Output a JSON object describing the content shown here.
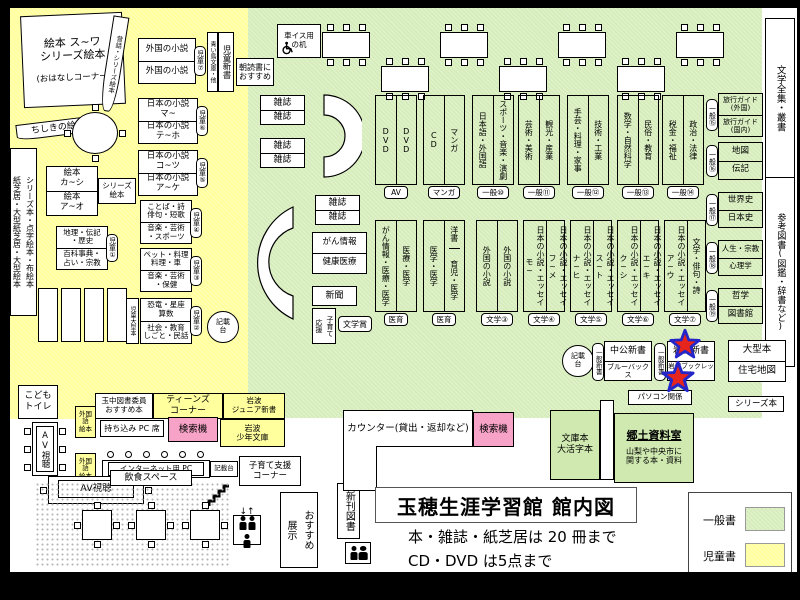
{
  "title": {
    "heading": "玉穂生涯学習館 館内図",
    "rule1": "本・雑誌・紙芝居は 20 冊まで",
    "rule2": "CD・DVD は5点まで"
  },
  "legend": {
    "general": "一般書",
    "children": "児童書"
  },
  "colors": {
    "children_area": "#ffff9e",
    "general_area": "#d6edbb",
    "search_machine": "#f7a3c8",
    "star_fill": "#e8251d",
    "star_outline": "#2426c8"
  },
  "children_area": {
    "ohanashi_line1": "絵本 ス~ワ",
    "ohanashi_line2": "シリーズ絵本",
    "ohanashi_line3": "(おはなしコーナー)",
    "mukashibanashi_strip": "昔話・シリーズ絵本",
    "chishiki_strip": "ちしきの絵本",
    "left_wall_strip": "シリーズ本・点字絵本・布絵本\n紙芝居・大型紙芝居・大型絵本",
    "ehon_top": "絵本\nカ~シ",
    "ehon_bottom": "絵本\nア~オ",
    "ehon_side": "シリーズ\n絵本",
    "ref_top": "地理・伝記\n・歴史",
    "ref_bottom": "百科事典・\n占い・宗教",
    "ref_badge": "児童①",
    "foreign_top": "外国の小説",
    "foreign_bottom": "外国の小説",
    "foreign_badge": "児童⑦",
    "aoitori_strip": "青い鳥文庫・他",
    "jido_shinsho_strip": "児童新書",
    "asadoku": "朝読書に\nおすすめ",
    "jnovel1_top": "日本の小説\nマ~",
    "jnovel1_bottom": "日本の小説\nテ~ホ",
    "jnovel1_badge": "児童⑥",
    "jnovel2_top": "日本の小説\nコ~ツ",
    "jnovel2_bottom": "日本の小説\nア~ケ",
    "jnovel2_badge": "児童⑤",
    "kotoba_top": "ことば・詩\n俳句・短歌",
    "kotoba_bottom": "音楽・芸術\n・スポーツ",
    "kotoba_badge": "児童④",
    "pet_top": "ペット・料理\n料理・車",
    "pet_bottom": "音楽・芸術\n・保健",
    "pet_badge": "児童③",
    "kyoryu_top": "恐竜・星座\n算数",
    "kyoryu_bottom": "社会・教育\nしごと・民話",
    "kyoryu_badge": "児童②",
    "kyoryu_side": "児童大型本",
    "kisaidai_circle": "記載\n台",
    "kids_toilet": "こども\nトイレ"
  },
  "teens_area": {
    "recommend": "玉中図書委員\nおすすめ本",
    "teens_corner": "ティーンズ\nコーナー",
    "iwanami_junior": "岩波\nジュニア新書",
    "foreign_picture1": "外国語\n絵本",
    "foreign_picture2": "外国語\n絵本",
    "byo_pc": "持ち込み PC 席",
    "search1": "検索機",
    "iwanami_shonen": "岩波\n少年文庫"
  },
  "facilities": {
    "av_table": "AV視聴",
    "av_booth": "AV視聴",
    "internet_pc": "インターネット用 PC",
    "kisaidai_small": "記載台",
    "kosodate": "子育て支援\nコーナー",
    "osusume_tenji": "おすすめ\n展示",
    "eating_space": "飲食スペース",
    "new_books": "新刊図書",
    "elevator_arrows": "↓↑"
  },
  "counter_area": {
    "counter": "カウンター(貸出・返却など)",
    "search2": "検索機",
    "bunkobon": "文庫本\n大活字本",
    "kyodo_title": "郷土資料室",
    "kyodo_sub": "山梨や中央市に\n関する本・資料",
    "pc_related": "パソコン関係",
    "series_bon": "シリーズ本"
  },
  "general_area": {
    "wheelchair_desk": "車イス用\nの机",
    "magazine": "雑誌",
    "cancer_info": "がん情報",
    "health": "健康医療",
    "newspaper": "新聞",
    "kosodate_ouen": "子育て\n応援",
    "bungakusho": "文学賞",
    "row1": [
      {
        "left": "DVD",
        "right": "DVD",
        "badge": "AV"
      },
      {
        "left": "CD",
        "right": "マンガ",
        "badge": "マンガ"
      },
      {
        "left": "日本語・外国語",
        "right": "スポーツ・音楽・演劇",
        "badge": "一般⑩"
      },
      {
        "left": "芸術・美術",
        "right": "観光・産業",
        "badge": "一般⑪"
      },
      {
        "left": "手芸・料理・家事",
        "right": "技術・工業",
        "badge": "一般⑫"
      },
      {
        "left": "数学・自然科学",
        "right": "民俗・教育",
        "badge": "一般⑬"
      },
      {
        "left": "税金・福祉",
        "right": "政治・法律",
        "badge": "一般⑭"
      }
    ],
    "row2": [
      {
        "left": "がん情報・医療・医学",
        "right": "医療・医学",
        "badge": "医育"
      },
      {
        "left": "医学・医学",
        "right_top": "洋書",
        "right_bottom": "育児・医学",
        "badge": "医育"
      },
      {
        "left": "外国の小説",
        "right": "外国の小説",
        "badge": "文学③"
      },
      {
        "left": "日本の小説・エッセイ\nモ~",
        "right": "日本の小説・エッセイ\nフ~メ",
        "badge": "文学④"
      },
      {
        "left": "日本の小説・エッセイ\nナ~ヒ",
        "right": "日本の小説・エッセイ\nス~ト",
        "badge": "文学⑤"
      },
      {
        "left": "日本の小説・エッセイ\nク~シ",
        "right": "日本の小説・エッセイ\nエ~キ",
        "badge": "文学⑥"
      },
      {
        "left": "日本の小説・エッセイ\nア~ウ",
        "right": "文学・俳句・詩",
        "badge": "文学⑦"
      }
    ],
    "right_col": [
      {
        "top": "旅行ガイド\n(外国)",
        "bottom": "旅行ガイド\n(国内)",
        "badge": "一般⑮"
      },
      {
        "top": "地図",
        "bottom": "伝記",
        "badge": "一般⑯"
      },
      {
        "top": "世界史",
        "bottom": "日本史",
        "badge": "一般⑰"
      },
      {
        "top": "人生・宗教",
        "bottom": "心理学",
        "badge": "一般⑱"
      },
      {
        "top": "哲学",
        "bottom": "図書館",
        "badge": "一般⑲"
      }
    ],
    "far_right_top": "文学全集・叢書",
    "far_right_bottom": "参考図書(図鑑・辞書など)",
    "shinsho_badge1": "一般新書",
    "shinsho_badge2": "一般新書",
    "chuko": "中公新書",
    "bluebacks": "ブルーバックス",
    "iwanami_shinsho": "岩波新書",
    "iwanami_booklet": "岩波ブックレット",
    "ogata": "大型本",
    "jutaku": "住宅地図",
    "kisaidai2": "記載\n台"
  }
}
